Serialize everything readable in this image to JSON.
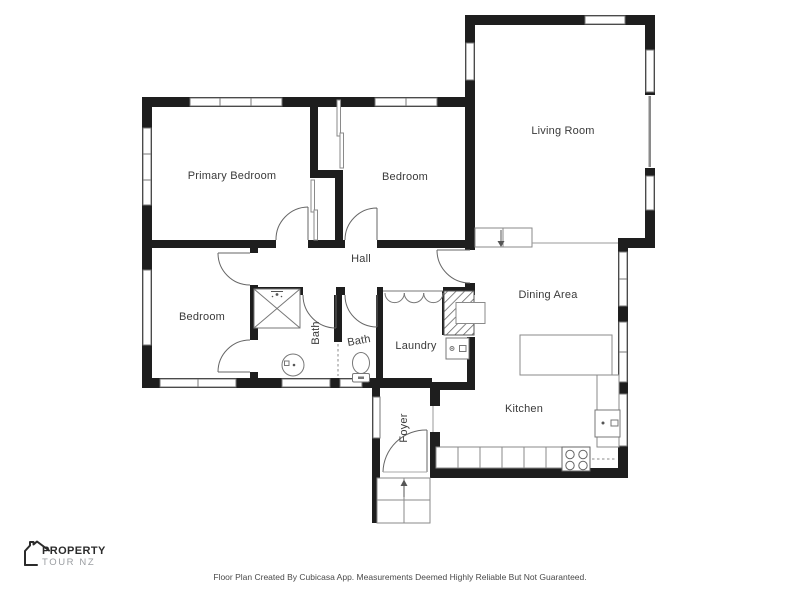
{
  "page": {
    "footer_disclaimer": "Floor Plan Created By Cubicasa App. Measurements Deemed Highly Reliable But Not Guaranteed."
  },
  "brand": {
    "logo_icon": "house-outline-icon",
    "line1": "PROPERTY",
    "line2": "TOUR NZ"
  },
  "floorplan": {
    "rooms": {
      "primary_bedroom": {
        "label": "Primary Bedroom"
      },
      "bedroom_top": {
        "label": "Bedroom"
      },
      "living_room": {
        "label": "Living Room"
      },
      "hall": {
        "label": "Hall"
      },
      "bedroom_left": {
        "label": "Bedroom"
      },
      "bath_main": {
        "label": "Bath"
      },
      "bath_second": {
        "label": "Bath"
      },
      "laundry": {
        "label": "Laundry"
      },
      "dining_area": {
        "label": "Dining Area"
      },
      "kitchen": {
        "label": "Kitchen"
      },
      "foyer": {
        "label": "Foyer"
      }
    },
    "fixtures": [
      "shower-icon",
      "pedestal-sink-icon",
      "toilet-icon",
      "washing-machine-icon",
      "kitchen-sink-icon",
      "stove-cooktop-icon",
      "hot-water-cupboard-icon",
      "entry-steps",
      "step-down-arrow-icon",
      "entry-arrow-icon"
    ],
    "colors": {
      "wall": "#1e1e1e",
      "thin_line": "#888888",
      "label_text": "#3a3a3a"
    }
  }
}
